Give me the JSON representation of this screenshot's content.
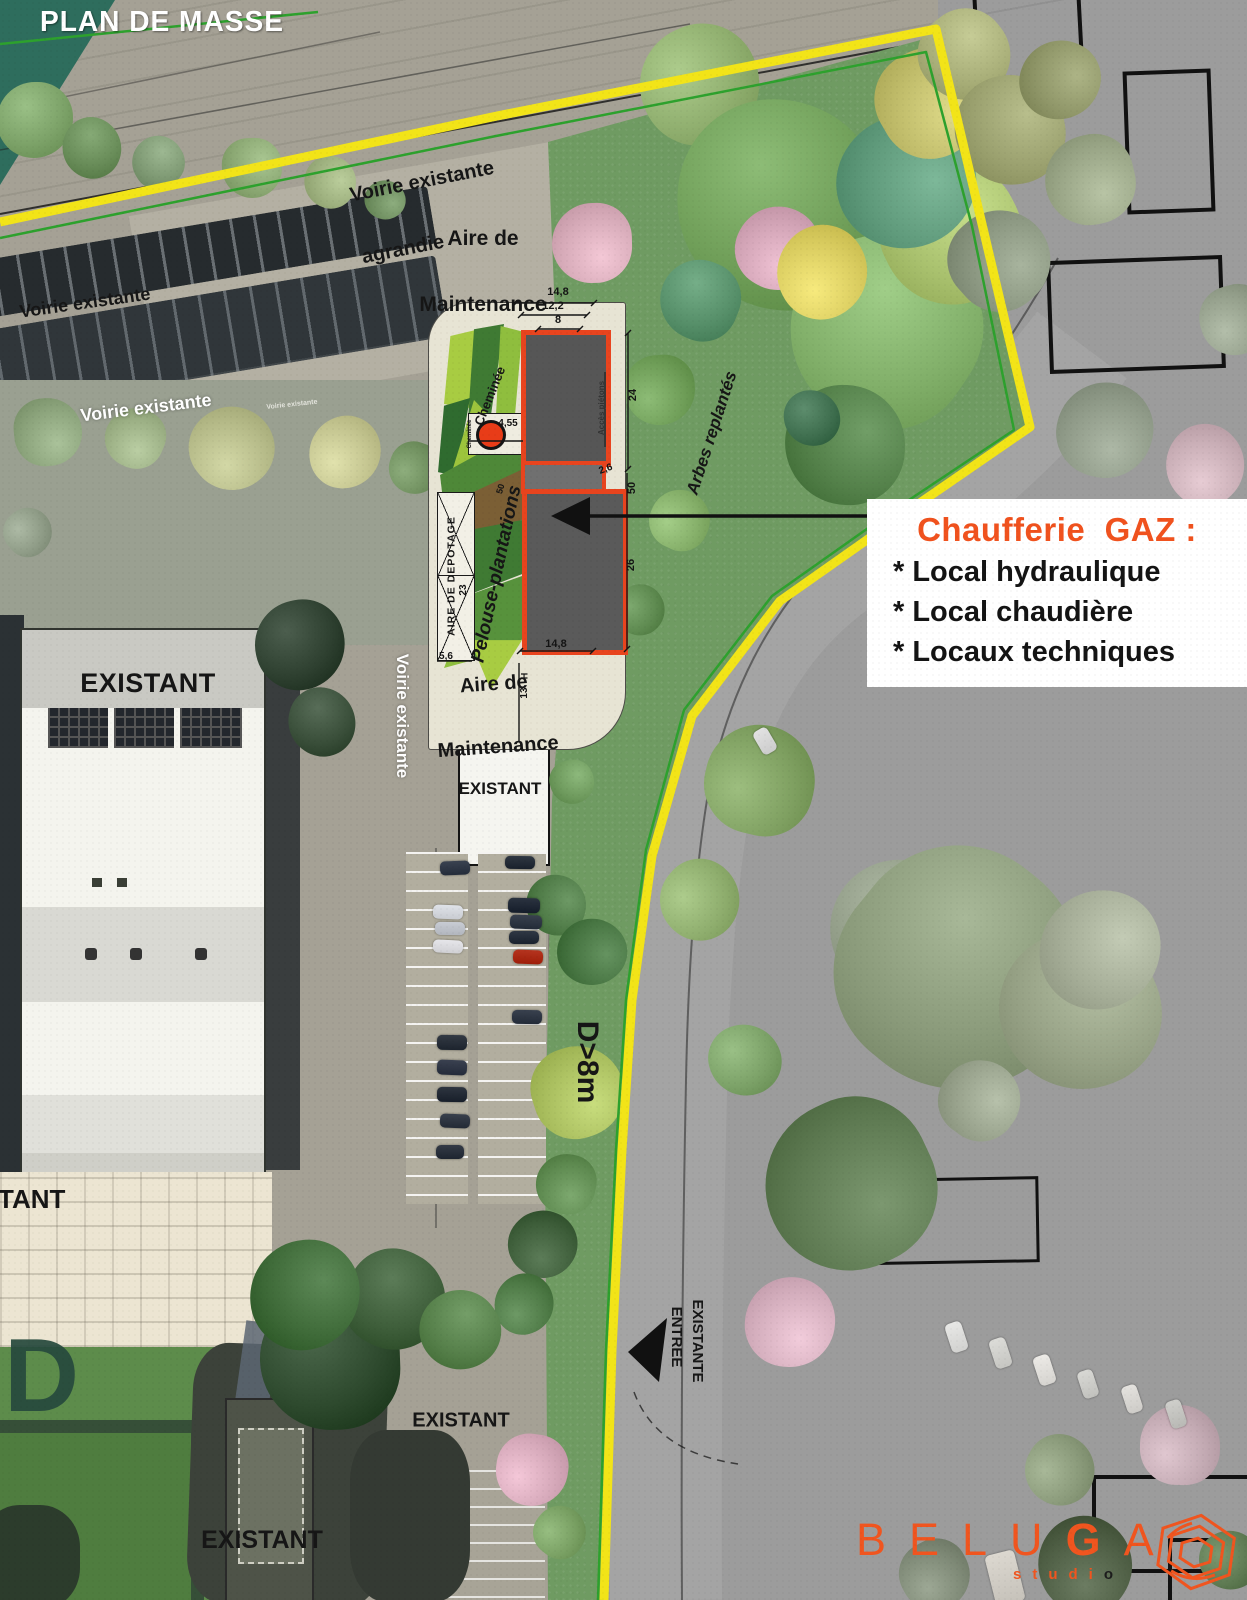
{
  "title": "PLAN DE MASSE",
  "map_labels": {
    "voirie_top": "Voirie existante",
    "voirie_mid": "Voirie existante",
    "voirie_tiny": "Voirie existante",
    "voirie_agrandie_line1": "Voirie existante",
    "voirie_agrandie_line2": "agrandie",
    "voirie_vertical": "Voirie existante",
    "aire_maintenance_line1": "Aire de",
    "aire_maintenance_line2": "Maintenance",
    "arbres_replantes": "Arbes replantés",
    "cheminee": "Cheminée",
    "cheminee_small": "Cheminée",
    "pelouse": "Pelouse-plantations",
    "aire_depotage": "AIRE DE DEPOTAGE",
    "acces_pietons": "Accès piétons",
    "d_8m": "D>8m",
    "entree_line1": "ENTREE",
    "entree_line2": "EXISTANTE",
    "existant_left": "EXISTANT",
    "existant_center": "EXISTANT",
    "existant_right": "EXISTANT",
    "existant_bottom": "EXISTANT",
    "existant_partial": "TANT",
    "watermark": "D"
  },
  "dimensions": {
    "top_14_8": "14,8",
    "top_12_2": "12,2",
    "top_8": "8",
    "right_24": "24",
    "right_50": "50",
    "right_2_6": "2,6",
    "right_26": "26",
    "bottom_14_8": "14,8",
    "chimney_4_55": "4,55",
    "depotage_5_6": "5,6",
    "depotage_23": "23",
    "height_13": "13",
    "height_H": "H",
    "pelouse_50": "50"
  },
  "callout": {
    "heading": "Chaufferie  GAZ :",
    "item1": "* Local hydraulique",
    "item2": "* Local chaudière",
    "item3": "* Locaux techniques"
  },
  "logo": {
    "pre": "BELU",
    "bold": "G",
    "post": "A",
    "sub_pre": "studi",
    "sub_last": "o"
  },
  "colors": {
    "boundary_yellow": "#f2e418",
    "limit_green": "#2da12d",
    "building_outline_orange": "#e8441e",
    "callout_orange": "#f0521e",
    "logo_orange": "#f0551f"
  }
}
